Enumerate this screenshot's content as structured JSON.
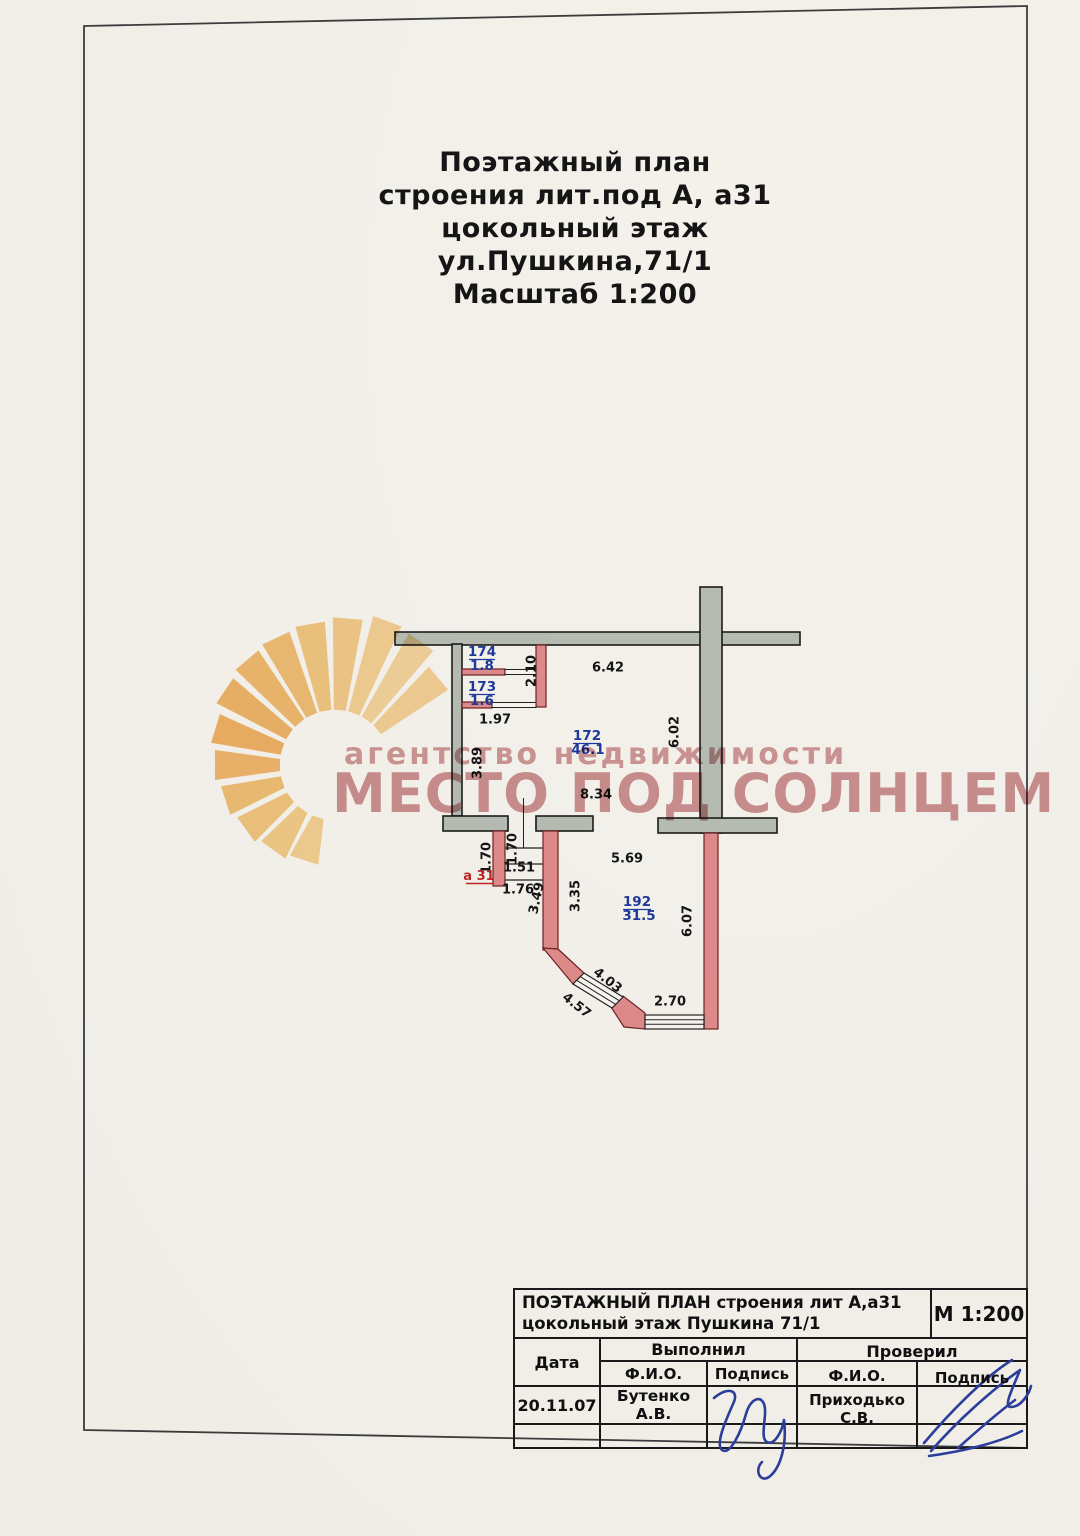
{
  "title": {
    "lines": [
      "Поэтажный план",
      "строения лит.под  А, а31",
      "цокольный этаж",
      "ул.Пушкина,71/1",
      "Масштаб 1:200"
    ]
  },
  "watermark": {
    "line1": "агентство недвижимости",
    "line2": "МЕСТО ПОД СОЛНЦЕМ"
  },
  "plan": {
    "rooms": [
      {
        "number": "174",
        "area": "1.8"
      },
      {
        "number": "173",
        "area": "1.6"
      },
      {
        "number": "172",
        "area": "46.1"
      },
      {
        "number": "192",
        "area": "31.5"
      }
    ],
    "annex_label": "а 31",
    "dims": [
      "6.42",
      "2.10",
      "1.97",
      "3.89",
      "6.02",
      "8.34",
      "5.69",
      "1.70",
      "1.70",
      "1.51",
      "1.76",
      "3.49",
      "3.35",
      "6.07",
      "4.03",
      "4.57",
      "2.70"
    ]
  },
  "titleblock": {
    "title_line1": "ПОЭТАЖНЫЙ ПЛАН строения лит А,а31",
    "title_line2": "цокольный этаж  Пушкина 71/1",
    "scale": "М 1:200",
    "date_label": "Дата",
    "executed_label": "Выполнил",
    "checked_label": "Проверил",
    "fio_label_1": "Ф.И.О.",
    "signature_label_1": "Подпись",
    "fio_label_2": "Ф.И.О.",
    "signature_label_2": "Подпись",
    "date_value": "20.11.07",
    "executor_name": "Бутенко А.В.",
    "checker_name": "Приходько С.В."
  },
  "colors": {
    "paper": "#f7f4ee",
    "wall_gray": "#b8beb4",
    "wall_red": "#e18b8c",
    "label_blue": "#1e3a9c",
    "label_red": "#c22323",
    "watermark_pink": "#c3777a",
    "sun_orange": "#f2b058",
    "ink_blue": "#2b3f9e"
  }
}
